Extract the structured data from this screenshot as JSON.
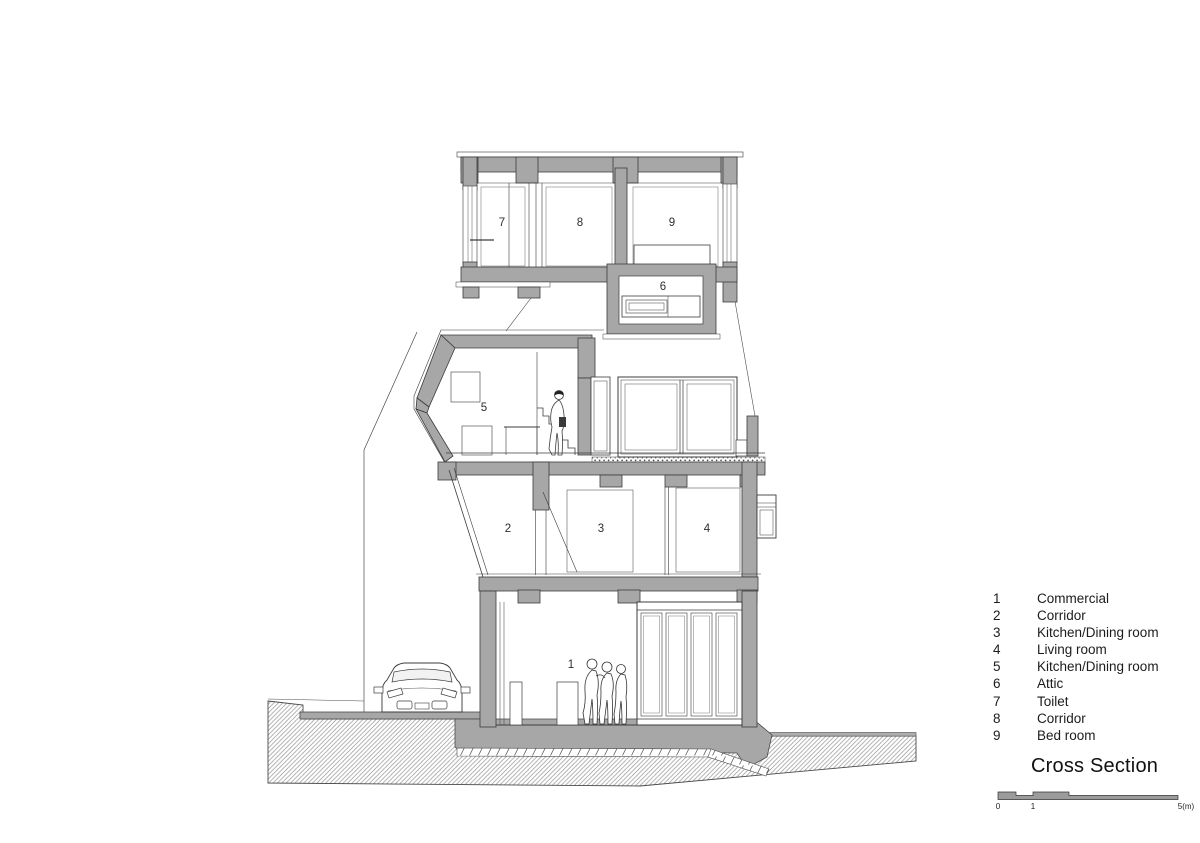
{
  "drawing": {
    "room_labels": [
      {
        "number": "1",
        "name": "Commercial"
      },
      {
        "number": "2",
        "name": "Corridor"
      },
      {
        "number": "3",
        "name": "Kitchen/Dining room"
      },
      {
        "number": "4",
        "name": "Living room"
      },
      {
        "number": "5",
        "name": "Kitchen/Dining room"
      },
      {
        "number": "6",
        "name": "Attic"
      },
      {
        "number": "7",
        "name": "Toilet"
      },
      {
        "number": "8",
        "name": "Corridor"
      },
      {
        "number": "9",
        "name": "Bed room"
      }
    ]
  },
  "legend": {
    "items": [
      {
        "number": "1",
        "label": "Commercial"
      },
      {
        "number": "2",
        "label": "Corridor"
      },
      {
        "number": "3",
        "label": "Kitchen/Dining room"
      },
      {
        "number": "4",
        "label": "Living room"
      },
      {
        "number": "5",
        "label": "Kitchen/Dining room"
      },
      {
        "number": "6",
        "label": "Attic"
      },
      {
        "number": "7",
        "label": "Toilet"
      },
      {
        "number": "8",
        "label": "Corridor"
      },
      {
        "number": "9",
        "label": "Bed room"
      }
    ],
    "title": "Cross Section"
  },
  "scale_bar": {
    "labels": [
      "0",
      "1",
      "5(m)"
    ]
  },
  "colors": {
    "wall_gray": "#a7a7a7",
    "line": "#3c3c3c"
  }
}
